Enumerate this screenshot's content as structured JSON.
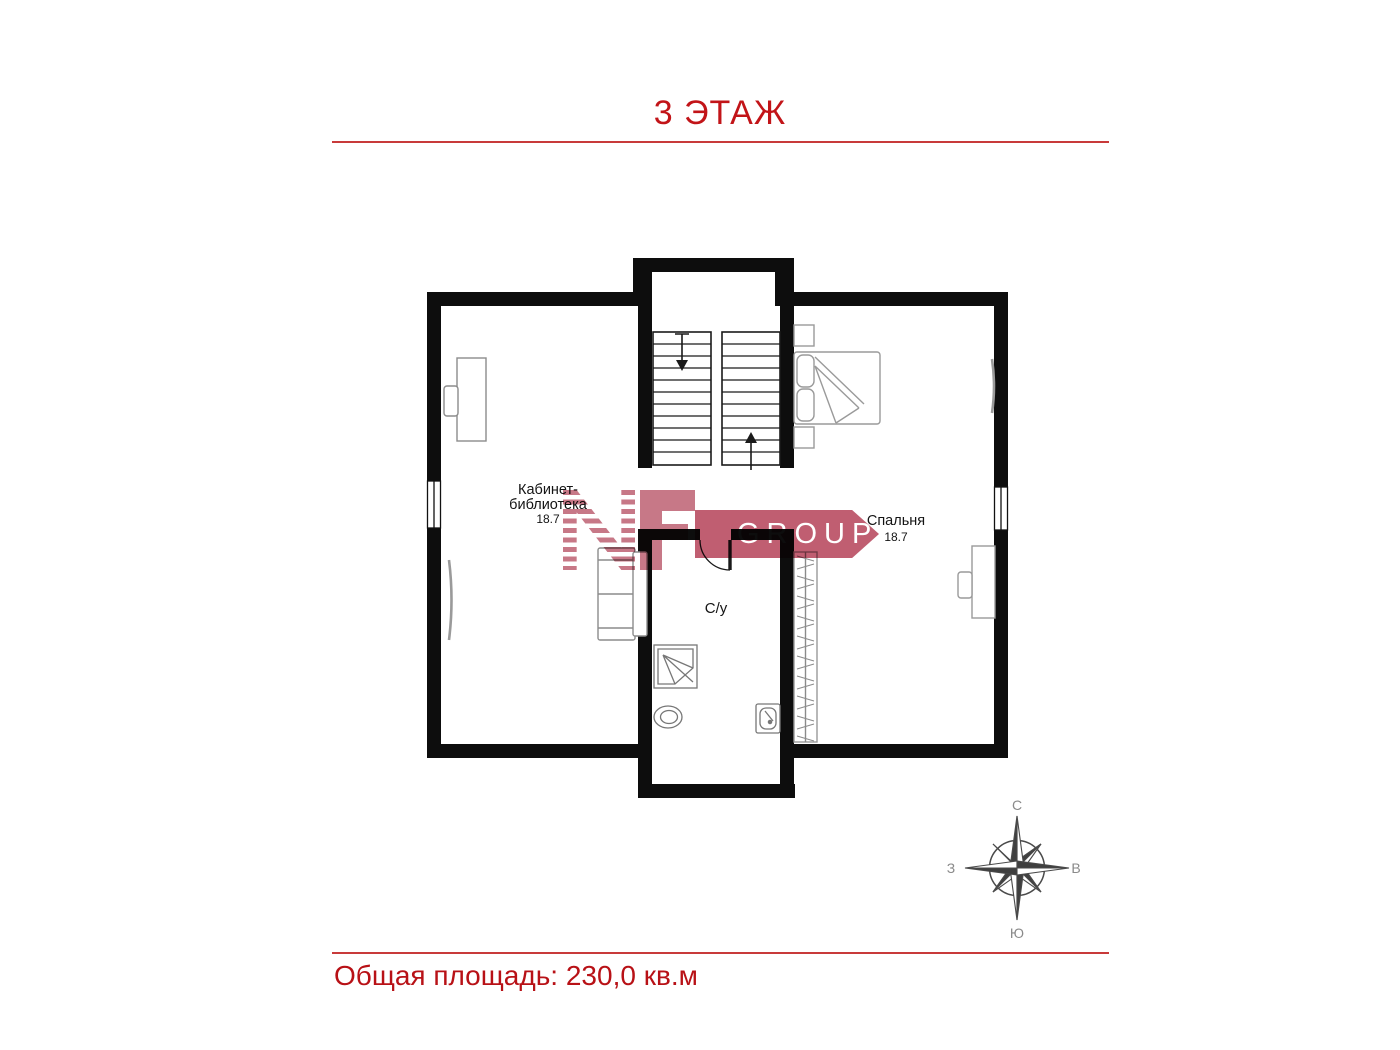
{
  "page": {
    "title": "3 ЭТАЖ",
    "footer_text": "Общая площадь: 230,0 кв.м"
  },
  "plan": {
    "rooms": [
      {
        "id": "office",
        "label_line1": "Кабинет-",
        "label_line2": "библиотека",
        "area": "18.7"
      },
      {
        "id": "bedroom",
        "label": "Спальня",
        "area": "18.7"
      },
      {
        "id": "bathroom",
        "label": "С/у"
      }
    ]
  },
  "compass": {
    "north": "С",
    "south": "Ю",
    "west": "З",
    "east": "В"
  },
  "logo": {
    "letters": "NF",
    "group_text": "GROUP"
  },
  "colors": {
    "accent_red": "#c21418",
    "rule_red": "#c83a3a",
    "logo_rose": "#c4707f",
    "banner_rose": "#bc5468",
    "wall_black": "#0d0d0d"
  }
}
